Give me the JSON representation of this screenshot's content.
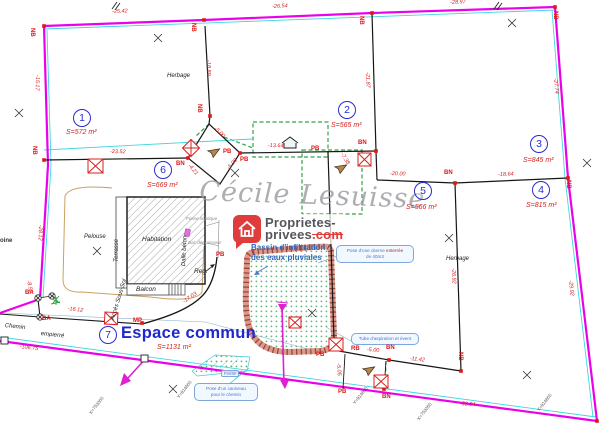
{
  "watermark": "Cécile Lesuisse",
  "logo": {
    "l1": "Proprietes-",
    "l2a": "privees",
    "l2b": ".com"
  },
  "bassin": {
    "l1": "Bassin d'infiltration",
    "l2": "des eaux pluviales"
  },
  "callouts": {
    "citerne": {
      "l1a": "Pose d'une citerne ",
      "l1b": "enterrée",
      "l2": "de 40m3"
    },
    "aspiration": {
      "l1": "Tube d'aspiration et évent"
    },
    "caniveau": {
      "l1": "Pose d'un caniveau",
      "l2": "pour le chemin"
    },
    "fosse_box": "Fossé"
  },
  "parcels": [
    {
      "num": "1",
      "area": "S=572 m²",
      "cx": 82,
      "cy": 118,
      "ax": 66,
      "ay": 129
    },
    {
      "num": "2",
      "area": "S=565 m²",
      "cx": 347,
      "cy": 110,
      "ax": 331,
      "ay": 122
    },
    {
      "num": "3",
      "area": "S=845 m²",
      "cx": 539,
      "cy": 144,
      "ax": 523,
      "ay": 157
    },
    {
      "num": "4",
      "area": "S=815 m²",
      "cx": 541,
      "cy": 190,
      "ax": 526,
      "ay": 202
    },
    {
      "num": "5",
      "area": "S=566 m²",
      "cx": 423,
      "cy": 191,
      "ax": 406,
      "ay": 204
    },
    {
      "num": "6",
      "area": "S=669 m²",
      "cx": 163,
      "cy": 170,
      "ax": 147,
      "ay": 182
    },
    {
      "num": "7",
      "area": "S=1131 m²",
      "cx": 108,
      "cy": 335,
      "ax": 157,
      "ay": 344,
      "name": "Espace commun",
      "nx": 121,
      "ny": 324
    }
  ],
  "measurements": [
    {
      "t": "-25.42",
      "x": 112,
      "y": 9,
      "r": -2
    },
    {
      "t": "-26.54",
      "x": 272,
      "y": 4,
      "r": -3
    },
    {
      "t": "-28.97",
      "x": 450,
      "y": 0,
      "r": -3
    },
    {
      "t": "-15.17",
      "x": 40,
      "y": 75,
      "r": 91
    },
    {
      "t": "-28.12",
      "x": 43,
      "y": 225,
      "r": 91
    },
    {
      "t": "-18.89",
      "x": 211,
      "y": 60,
      "r": 89
    },
    {
      "t": "-21.87",
      "x": 370,
      "y": 72,
      "r": 88
    },
    {
      "t": "-27.74",
      "x": 558,
      "y": 78,
      "r": 85
    },
    {
      "t": "-23.52",
      "x": 110,
      "y": 149,
      "r": 1
    },
    {
      "t": "-13.64",
      "x": 268,
      "y": 143,
      "r": 1
    },
    {
      "t": "-5.00",
      "x": 217,
      "y": 126,
      "r": 45
    },
    {
      "t": "-5.00",
      "x": 226,
      "y": 167,
      "r": -48
    },
    {
      "t": "-4.21",
      "x": 191,
      "y": 163,
      "r": 50
    },
    {
      "t": "-7.38",
      "x": 344,
      "y": 152,
      "r": 58
    },
    {
      "t": "-20.00",
      "x": 390,
      "y": 171,
      "r": 2
    },
    {
      "t": "-18.64",
      "x": 498,
      "y": 172,
      "r": -2
    },
    {
      "t": "-26.92",
      "x": 456,
      "y": 268,
      "r": 88
    },
    {
      "t": "-29.92",
      "x": 573,
      "y": 280,
      "r": 84
    },
    {
      "t": "-16.12",
      "x": 68,
      "y": 306,
      "r": 7
    },
    {
      "t": "-17.03",
      "x": 182,
      "y": 300,
      "r": -35
    },
    {
      "t": "-11.42",
      "x": 410,
      "y": 356,
      "r": 6
    },
    {
      "t": "-5.00",
      "x": 367,
      "y": 347,
      "r": 4
    },
    {
      "t": "-5.05",
      "x": 341,
      "y": 363,
      "r": 86
    },
    {
      "t": "-38.84",
      "x": 460,
      "y": 401,
      "r": 4
    },
    {
      "t": "-106.75",
      "x": 20,
      "y": 344,
      "r": 7
    },
    {
      "t": "-8.52",
      "x": 31,
      "y": 280,
      "r": 78
    }
  ],
  "markers": [
    {
      "t": "NB",
      "x": 35,
      "y": 28,
      "r": 90
    },
    {
      "t": "NB",
      "x": 196,
      "y": 23,
      "r": 90
    },
    {
      "t": "NB",
      "x": 364,
      "y": 16,
      "r": 90
    },
    {
      "t": "NB",
      "x": 558,
      "y": 11,
      "r": 90
    },
    {
      "t": "NB",
      "x": 202,
      "y": 104,
      "r": 90
    },
    {
      "t": "NB",
      "x": 37,
      "y": 146,
      "r": 90
    },
    {
      "t": "BN",
      "x": 176,
      "y": 161
    },
    {
      "t": "PB",
      "x": 223,
      "y": 149
    },
    {
      "t": "PB",
      "x": 240,
      "y": 157
    },
    {
      "t": "PB",
      "x": 311,
      "y": 146
    },
    {
      "t": "BN",
      "x": 358,
      "y": 140
    },
    {
      "t": "BN",
      "x": 444,
      "y": 170
    },
    {
      "t": "NB",
      "x": 571,
      "y": 180,
      "r": 90
    },
    {
      "t": "NB",
      "x": 463,
      "y": 352,
      "r": 90
    },
    {
      "t": "BN",
      "x": 386,
      "y": 345
    },
    {
      "t": "RB",
      "x": 351,
      "y": 346
    },
    {
      "t": "PB",
      "x": 316,
      "y": 352
    },
    {
      "t": "BN",
      "x": 382,
      "y": 394
    },
    {
      "t": "PB",
      "x": 338,
      "y": 389
    },
    {
      "t": "PB",
      "x": 216,
      "y": 252
    },
    {
      "t": "MP",
      "x": 133,
      "y": 318
    },
    {
      "t": "BA",
      "x": 25,
      "y": 290
    },
    {
      "t": "BA",
      "x": 42,
      "y": 316
    }
  ],
  "land_labels": [
    {
      "t": "Herbage",
      "x": 167,
      "y": 73
    },
    {
      "t": "Herbage",
      "x": 446,
      "y": 256
    },
    {
      "t": "Pelouse",
      "x": 84,
      "y": 234
    },
    {
      "t": "Habitation",
      "x": 142,
      "y": 236,
      "cls": "bld"
    },
    {
      "t": "Terrasse",
      "x": 114,
      "y": 262,
      "r": -90
    },
    {
      "t": "Balcon",
      "x": 136,
      "y": 286,
      "cls": "bld"
    },
    {
      "t": "Dalle béton",
      "x": 181,
      "y": 266,
      "r": -87
    },
    {
      "t": "Accès Sous-Sol",
      "x": 110,
      "y": 319,
      "r": -73
    },
    {
      "t": "Reg.",
      "x": 194,
      "y": 268,
      "cls": "bld"
    },
    {
      "t": "Fosse septique",
      "x": 186,
      "y": 216,
      "cls": "gray"
    },
    {
      "t": "Bac dégraisseur",
      "x": 188,
      "y": 240,
      "cls": "gray"
    },
    {
      "t": "Chemin",
      "x": 5,
      "y": 323,
      "r": 6
    },
    {
      "t": "empierré",
      "x": 41,
      "y": 331,
      "r": 6
    },
    {
      "t": "oine",
      "x": 0,
      "y": 238,
      "cls": "edge"
    }
  ],
  "coord_marks": [
    {
      "t": "X=753300",
      "x": 88,
      "y": 412
    },
    {
      "t": "Y=914600",
      "x": 176,
      "y": 396
    },
    {
      "t": "Y=914600",
      "x": 352,
      "y": 402
    },
    {
      "t": "X=753350",
      "x": 416,
      "y": 418
    },
    {
      "t": "Y=914600",
      "x": 536,
      "y": 409
    }
  ],
  "colors": {
    "boundary": "#ea00ea",
    "offset": "#3fd6e0",
    "survey": "#d42020",
    "parcel_blue": "#2b2bcf",
    "green_dashed": "#35a246",
    "logo_red": "#e13c3c"
  }
}
